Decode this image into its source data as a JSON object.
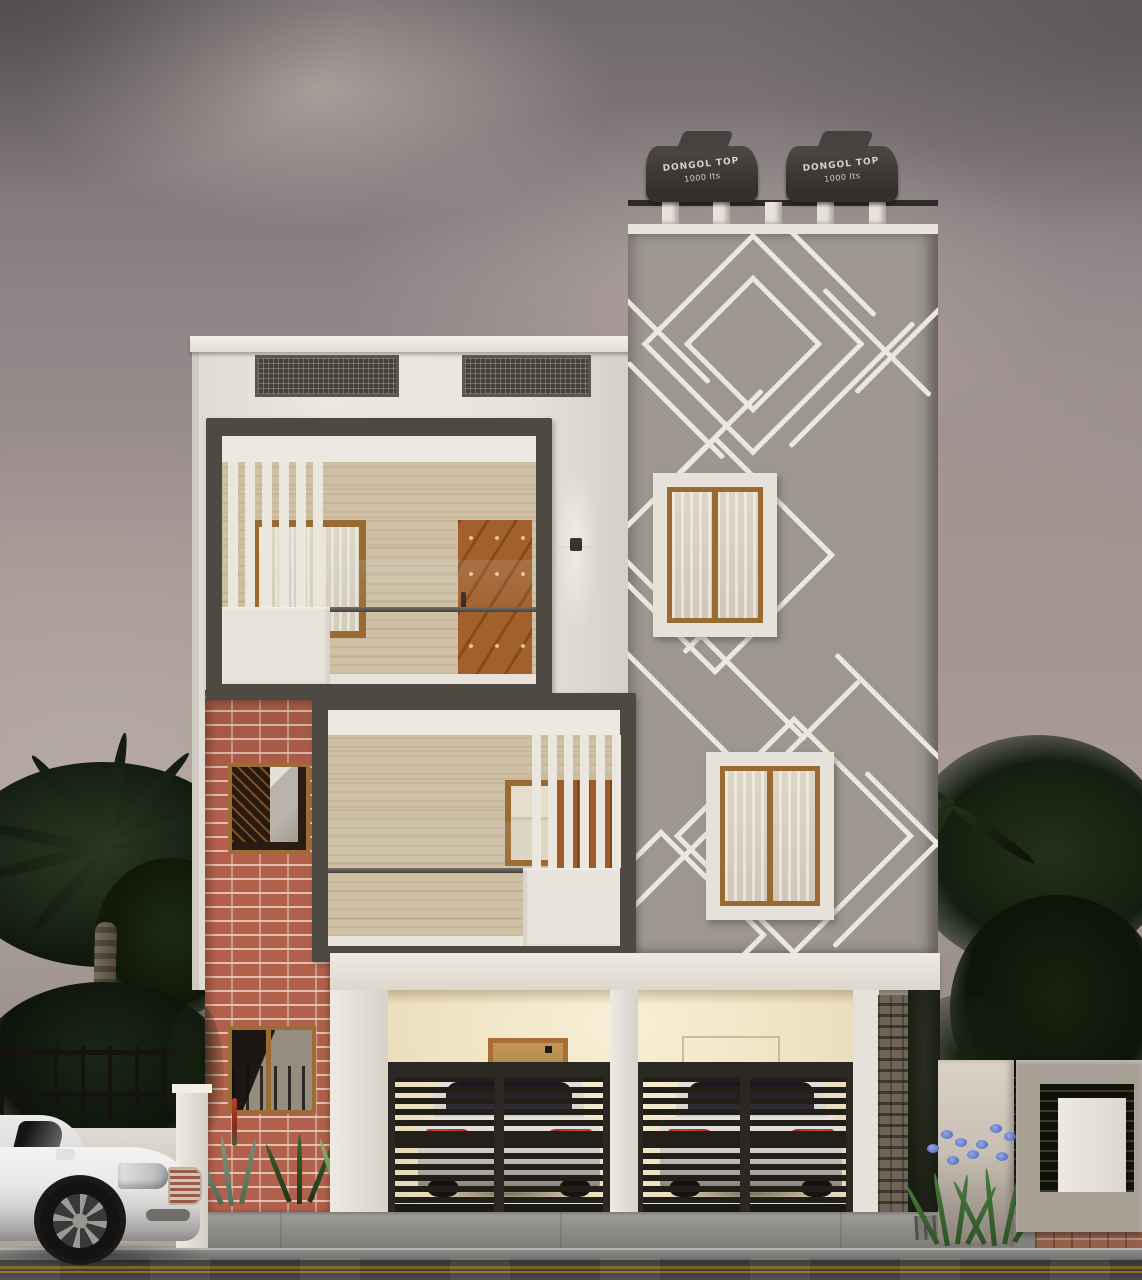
{
  "scene": {
    "type": "architectural-3d-render",
    "setting": "modern two-storey duplex house exterior at dusk with palm trees, parked sedan, twin car garage and wet asphalt street",
    "tank_label": {
      "line1": "DONGOL TOP",
      "line2": "1000 lts"
    },
    "counts": {
      "roof_water_tanks": 2,
      "roof_vents": 2,
      "parapet_blocks": 5,
      "feature_wall_windows": 2,
      "balconies": 2,
      "brick_wall_windows": 2,
      "garage_gates": 2,
      "cars_behind_gates": 2,
      "parked_sedans": 1
    },
    "palette": {
      "sky": "#968b8c",
      "cloud_light": "#c3b4ab",
      "facade_white": "#e9e4dc",
      "feature_wall_gray": "#9d9790",
      "pattern_line_white": "#ece7e0",
      "balcony_frame_dark": "#4f4943",
      "interior_wood_wall": "#cfc0a4",
      "door_wood": "#a2602a",
      "window_frame_wood": "#9a6a33",
      "brick_red": "#b2604b",
      "gate_dark": "#24211d",
      "garage_warm_light": "#f6edd3",
      "taillight_red": "#b02a26",
      "foliage_dark": "#18231a",
      "flower_blue": "#7186cc",
      "road_asphalt": "#454449",
      "road_line_yellow": "#9c7428",
      "sidewalk_gray": "#8b8a86",
      "sedan_white": "#e9e8e6",
      "tank_dark": "#3f3c38"
    }
  }
}
